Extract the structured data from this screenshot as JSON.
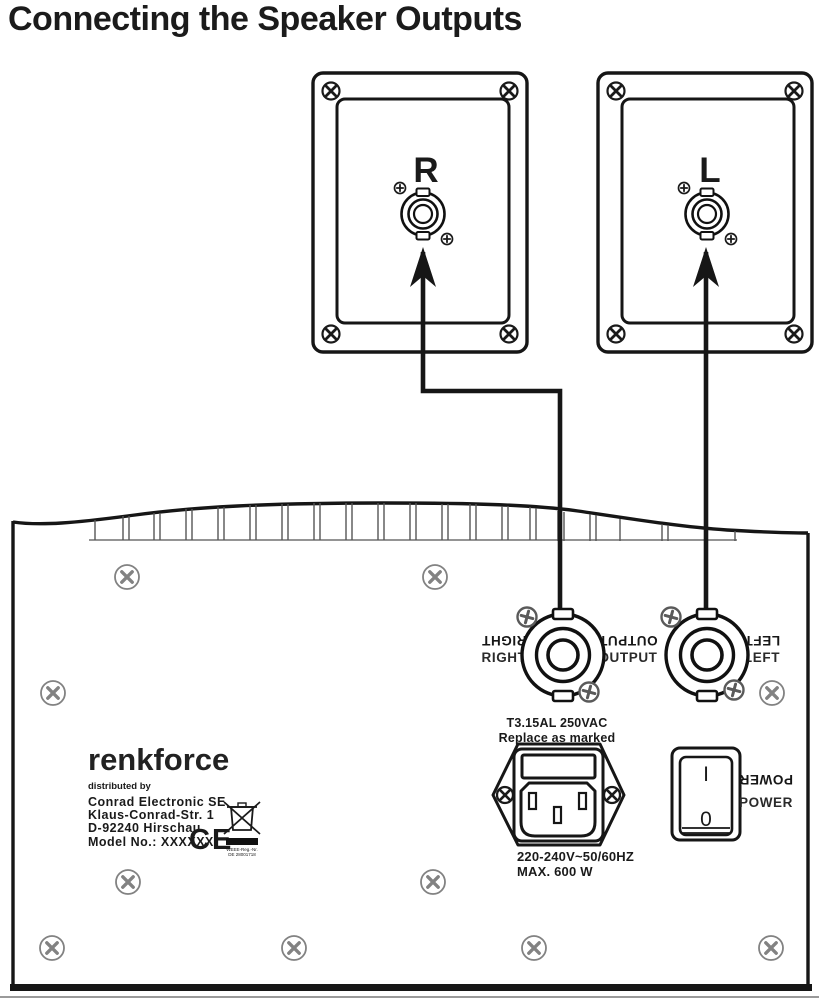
{
  "title": "Connecting the Speaker Outputs",
  "speaker_panels": {
    "right": {
      "label": "R"
    },
    "left": {
      "label": "L"
    }
  },
  "amplifier": {
    "output_section": {
      "right_label": "RIGHT",
      "output_label": "OUTPUT",
      "left_label": "LEFT"
    },
    "power_switch": {
      "label": "POWER",
      "on": "I",
      "off": "0"
    },
    "fuse": {
      "rating": "T3.15AL 250VAC",
      "note": "Replace as marked"
    },
    "power_specs": {
      "voltage": "220-240V~50/60HZ",
      "max_power": "MAX. 600 W"
    },
    "branding": {
      "brand": "renkforce",
      "distributed_by": "distributed by",
      "company": "Conrad Electronic SE",
      "address_line1": "Klaus-Conrad-Str. 1",
      "address_line2": "D-92240 Hirschau",
      "model": "Model No.: XXXXXX",
      "ce_mark": "CE",
      "weee_reg_line1": "WEEE-Reg.-Nr.",
      "weee_reg_line2": "DE 28001718"
    }
  },
  "icons": {
    "corner_screw": "circle-x-screw",
    "panel_screw": "circle-x-screw-gray",
    "phillips_screw": "circle-plus-screw",
    "inlet_screw": "circle-x-screw",
    "weee_bin": "crossed-out-wheelie-bin",
    "arrow": "up-arrow"
  },
  "colors": {
    "background": "#ffffff",
    "line": "#161616",
    "screw_gray": "#828282"
  }
}
